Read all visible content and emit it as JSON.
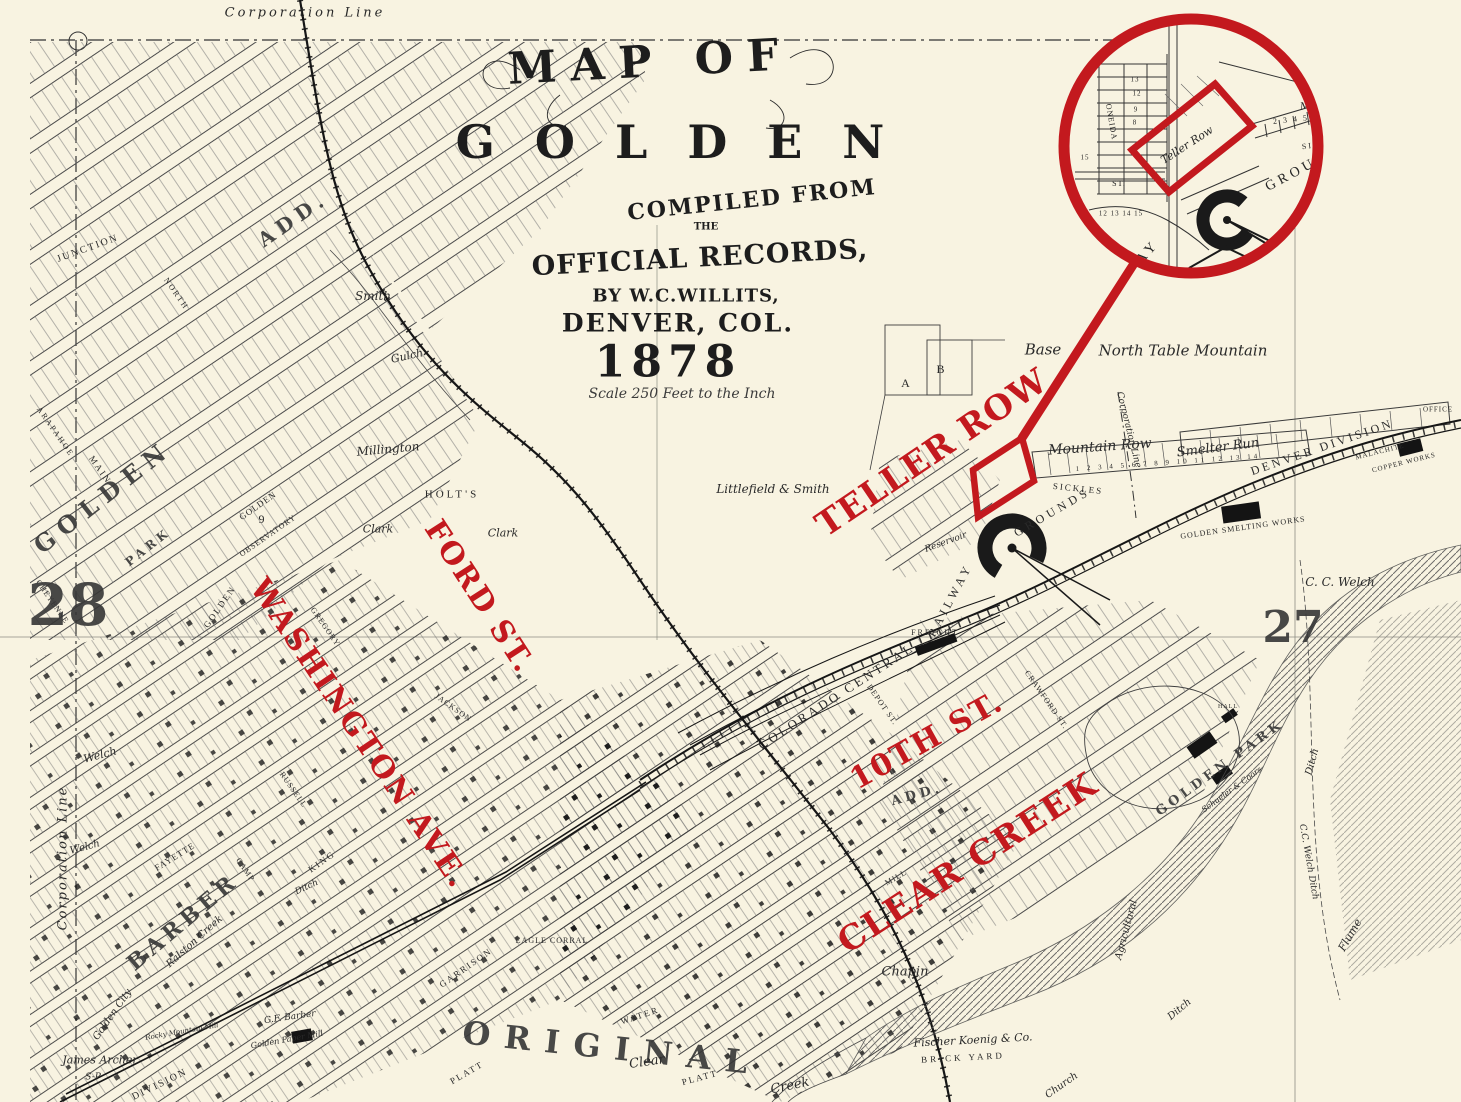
{
  "annotations": {
    "color": "#c3191e",
    "labels": [
      {
        "text": "TELLER ROW",
        "x": 932,
        "y": 453,
        "r": -34,
        "s": 34,
        "ls": 1,
        "cls": "red"
      },
      {
        "text": "FORD ST.",
        "x": 479,
        "y": 597,
        "r": 57,
        "s": 30,
        "ls": 2,
        "cls": "red"
      },
      {
        "text": "WASHINGTON AVE.",
        "x": 359,
        "y": 734,
        "r": 56,
        "s": 30,
        "ls": 2,
        "cls": "red"
      },
      {
        "text": "10TH ST.",
        "x": 927,
        "y": 741,
        "r": -29,
        "s": 30,
        "ls": 2,
        "cls": "red"
      },
      {
        "text": "CLEAR CREEK",
        "x": 968,
        "y": 863,
        "r": -33,
        "s": 34,
        "ls": 2,
        "cls": "red"
      }
    ]
  },
  "title_block": {
    "line_map_of": "MAP OF",
    "line_city": "GOLDEN",
    "line_compiled": "COMPILED FROM",
    "line_the": "THE",
    "line_records": "OFFICIAL RECORDS,",
    "line_by": "BY W.C.WILLITS,",
    "line_place": "DENVER, COL.",
    "line_year": "1878",
    "line_scale": "Scale 250 Feet to the Inch"
  },
  "map_labels": [
    {
      "text": "Corporation Line",
      "x": 305,
      "y": 13,
      "r": 0,
      "s": 13,
      "cls": "hand",
      "ls": 3
    },
    {
      "text": "Corporation Line",
      "x": 63,
      "y": 858,
      "r": -90,
      "s": 13,
      "cls": "hand",
      "ls": 2
    },
    {
      "text": "Corporation Line",
      "x": 1128,
      "y": 430,
      "r": 76,
      "s": 9,
      "cls": "hand"
    },
    {
      "text": "Base",
      "x": 1043,
      "y": 350,
      "r": 0,
      "s": 15,
      "cls": "hand"
    },
    {
      "text": "North Table Mountain",
      "x": 1183,
      "y": 351,
      "r": 0,
      "s": 15,
      "cls": "hand"
    },
    {
      "text": "Littlefield & Smith",
      "x": 773,
      "y": 489,
      "r": 0,
      "s": 12,
      "cls": "hand"
    },
    {
      "text": "Smith",
      "x": 373,
      "y": 296,
      "r": 0,
      "s": 12,
      "cls": "hand"
    },
    {
      "text": "Gulch",
      "x": 407,
      "y": 356,
      "r": -12,
      "s": 11,
      "cls": "hand"
    },
    {
      "text": "Welch",
      "x": 100,
      "y": 755,
      "r": -15,
      "s": 11,
      "cls": "hand"
    },
    {
      "text": "Welch",
      "x": 85,
      "y": 848,
      "r": -15,
      "s": 10,
      "cls": "hand"
    },
    {
      "text": "Millington",
      "x": 388,
      "y": 449,
      "r": -5,
      "s": 12,
      "cls": "hand"
    },
    {
      "text": "HOLT'S",
      "x": 452,
      "y": 495,
      "r": 0,
      "s": 11,
      "cls": "eng",
      "ls": 3
    },
    {
      "text": "Clark",
      "x": 378,
      "y": 529,
      "r": 0,
      "s": 11,
      "cls": "hand"
    },
    {
      "text": "Clark",
      "x": 503,
      "y": 533,
      "r": 0,
      "s": 11,
      "cls": "hand"
    },
    {
      "text": "JUNCTION",
      "x": 88,
      "y": 249,
      "r": -20,
      "s": 10,
      "cls": "eng",
      "ls": 2
    },
    {
      "text": "ARAPAHOE",
      "x": 55,
      "y": 432,
      "r": 55,
      "s": 8,
      "cls": "eng",
      "ls": 2
    },
    {
      "text": "NORTH",
      "x": 176,
      "y": 294,
      "r": 55,
      "s": 8,
      "cls": "eng",
      "ls": 2
    },
    {
      "text": "GOLDEN",
      "x": 103,
      "y": 497,
      "r": -38,
      "s": 24,
      "cls": "big",
      "ls": 8
    },
    {
      "text": "PARK",
      "x": 148,
      "y": 547,
      "r": -38,
      "s": 12,
      "cls": "big",
      "ls": 4
    },
    {
      "text": "ADD.",
      "x": 293,
      "y": 219,
      "r": -35,
      "s": 20,
      "cls": "big",
      "ls": 6
    },
    {
      "text": "MAIN",
      "x": 100,
      "y": 470,
      "r": 55,
      "s": 9,
      "cls": "eng",
      "ls": 2
    },
    {
      "text": "CHEYENNE",
      "x": 52,
      "y": 602,
      "r": 55,
      "s": 8,
      "cls": "eng",
      "ls": 1
    },
    {
      "text": "GOLDEN",
      "x": 220,
      "y": 607,
      "r": -55,
      "s": 9,
      "cls": "eng",
      "ls": 2
    },
    {
      "text": "GOLDEN",
      "x": 258,
      "y": 506,
      "r": -35,
      "s": 9,
      "cls": "eng",
      "ls": 1
    },
    {
      "text": "9",
      "x": 262,
      "y": 519,
      "r": 0,
      "s": 12,
      "cls": "eng"
    },
    {
      "text": "OBSERVATORY",
      "x": 268,
      "y": 536,
      "r": -35,
      "s": 8,
      "cls": "eng",
      "ls": 1
    },
    {
      "text": "GREGORY",
      "x": 325,
      "y": 627,
      "r": 55,
      "s": 8,
      "cls": "eng",
      "ls": 1
    },
    {
      "text": "JACKSON",
      "x": 453,
      "y": 708,
      "r": 35,
      "s": 8,
      "cls": "eng",
      "ls": 1
    },
    {
      "text": "RUSSELL",
      "x": 293,
      "y": 790,
      "r": 55,
      "s": 8,
      "cls": "eng",
      "ls": 1
    },
    {
      "text": "KING",
      "x": 322,
      "y": 862,
      "r": -35,
      "s": 9,
      "cls": "eng",
      "ls": 2
    },
    {
      "text": "FAYETTE",
      "x": 175,
      "y": 857,
      "r": -32,
      "s": 9,
      "cls": "eng",
      "ls": 1
    },
    {
      "text": "CAMP",
      "x": 245,
      "y": 870,
      "r": 55,
      "s": 8,
      "cls": "eng",
      "ls": 1
    },
    {
      "text": "BARBER",
      "x": 183,
      "y": 922,
      "r": -40,
      "s": 22,
      "cls": "big",
      "ls": 5
    },
    {
      "text": "Ditch",
      "x": 307,
      "y": 888,
      "r": -25,
      "s": 9,
      "cls": "hand"
    },
    {
      "text": "Ralston Creek",
      "x": 195,
      "y": 942,
      "r": -42,
      "s": 10,
      "cls": "hand"
    },
    {
      "text": "Golden City",
      "x": 113,
      "y": 1015,
      "r": -55,
      "s": 10,
      "cls": "hand"
    },
    {
      "text": "James Archer",
      "x": 100,
      "y": 1060,
      "r": 0,
      "s": 11,
      "cls": "hand"
    },
    {
      "text": "S-P",
      "x": 93,
      "y": 1078,
      "r": 0,
      "s": 9,
      "cls": "hand"
    },
    {
      "text": "G.F. Barber",
      "x": 290,
      "y": 1018,
      "r": -8,
      "s": 9,
      "cls": "hand"
    },
    {
      "text": "Golden Paper Mill",
      "x": 287,
      "y": 1040,
      "r": -10,
      "s": 8,
      "cls": "hand"
    },
    {
      "text": "Rocky Mountain Mill",
      "x": 182,
      "y": 1032,
      "r": -10,
      "s": 7,
      "cls": "hand"
    },
    {
      "text": "DIVISION",
      "x": 160,
      "y": 1085,
      "r": -26,
      "s": 10,
      "cls": "eng",
      "ls": 2
    },
    {
      "text": "ORIGINAL",
      "x": 612,
      "y": 1048,
      "r": 6,
      "s": 32,
      "cls": "big",
      "ls": 14
    },
    {
      "text": "GARRISON",
      "x": 466,
      "y": 968,
      "r": -35,
      "s": 9,
      "cls": "eng",
      "ls": 2
    },
    {
      "text": "EAGLE CORRAL",
      "x": 552,
      "y": 941,
      "r": 0,
      "s": 8,
      "cls": "eng",
      "ls": 1
    },
    {
      "text": "PLATT",
      "x": 467,
      "y": 1073,
      "r": -30,
      "s": 9,
      "cls": "eng",
      "ls": 2
    },
    {
      "text": "PLATT",
      "x": 700,
      "y": 1078,
      "r": -15,
      "s": 9,
      "cls": "eng",
      "ls": 2
    },
    {
      "text": "WATER",
      "x": 640,
      "y": 1016,
      "r": -18,
      "s": 9,
      "cls": "eng",
      "ls": 2
    },
    {
      "text": "Clear",
      "x": 647,
      "y": 1062,
      "r": -8,
      "s": 13,
      "cls": "hand"
    },
    {
      "text": "Creek",
      "x": 790,
      "y": 1086,
      "r": -12,
      "s": 13,
      "cls": "hand"
    },
    {
      "text": "Chapin",
      "x": 905,
      "y": 972,
      "r": 0,
      "s": 13,
      "cls": "hand"
    },
    {
      "text": "Fischer Koenig & Co.",
      "x": 973,
      "y": 1040,
      "r": -3,
      "s": 11,
      "cls": "hand"
    },
    {
      "text": "BRICK YARD",
      "x": 963,
      "y": 1058,
      "r": -3,
      "s": 9,
      "cls": "eng",
      "ls": 3
    },
    {
      "text": "Church",
      "x": 1062,
      "y": 1086,
      "r": -35,
      "s": 10,
      "cls": "hand"
    },
    {
      "text": "Agricultural",
      "x": 1127,
      "y": 930,
      "r": -75,
      "s": 10,
      "cls": "hand"
    },
    {
      "text": "Flume",
      "x": 1350,
      "y": 935,
      "r": -60,
      "s": 11,
      "cls": "hand"
    },
    {
      "text": "Ditch",
      "x": 1313,
      "y": 762,
      "r": -75,
      "s": 10,
      "cls": "hand"
    },
    {
      "text": "Ditch",
      "x": 1180,
      "y": 1010,
      "r": -40,
      "s": 10,
      "cls": "hand"
    },
    {
      "text": "C. C. Welch",
      "x": 1340,
      "y": 582,
      "r": 0,
      "s": 12,
      "cls": "hand"
    },
    {
      "text": "C.C. Welch Ditch",
      "x": 1308,
      "y": 862,
      "r": 80,
      "s": 9,
      "cls": "hand"
    },
    {
      "text": "GOLDEN PARK",
      "x": 1220,
      "y": 768,
      "r": -36,
      "s": 13,
      "cls": "big",
      "ls": 4
    },
    {
      "text": "HALL",
      "x": 1228,
      "y": 707,
      "r": 0,
      "s": 6,
      "cls": "eng",
      "ls": 1
    },
    {
      "text": "Schueler & Coors",
      "x": 1232,
      "y": 790,
      "r": -36,
      "s": 8,
      "cls": "hand"
    },
    {
      "text": "Mountain Row",
      "x": 1100,
      "y": 447,
      "r": -4,
      "s": 14,
      "cls": "hand"
    },
    {
      "text": "1 2 3 4 5 6 7 8 9 10 11 12 13 14",
      "x": 1168,
      "y": 463,
      "r": -4,
      "s": 7,
      "cls": "eng",
      "ls": 3
    },
    {
      "text": "SICKLES",
      "x": 1078,
      "y": 489,
      "r": 6,
      "s": 9,
      "cls": "eng",
      "ls": 2
    },
    {
      "text": "RAILWAY",
      "x": 950,
      "y": 600,
      "r": -62,
      "s": 12,
      "cls": "eng",
      "ls": 4
    },
    {
      "text": "GROUNDS",
      "x": 1052,
      "y": 512,
      "r": -30,
      "s": 12,
      "cls": "eng",
      "ls": 4
    },
    {
      "text": "Smelter Run",
      "x": 1218,
      "y": 448,
      "r": -7,
      "s": 13,
      "cls": "hand"
    },
    {
      "text": "DENVER DIVISION",
      "x": 1322,
      "y": 447,
      "r": -19,
      "s": 12,
      "cls": "eng",
      "ls": 3
    },
    {
      "text": "MALACHITE",
      "x": 1380,
      "y": 452,
      "r": -14,
      "s": 7,
      "cls": "eng",
      "ls": 1
    },
    {
      "text": "COPPER WORKS",
      "x": 1404,
      "y": 463,
      "r": -14,
      "s": 7,
      "cls": "eng",
      "ls": 1
    },
    {
      "text": "OFFICE",
      "x": 1438,
      "y": 410,
      "r": 0,
      "s": 7,
      "cls": "eng",
      "ls": 1
    },
    {
      "text": "GOLDEN SMELTING WORKS",
      "x": 1243,
      "y": 528,
      "r": -8,
      "s": 8,
      "cls": "eng",
      "ls": 1
    },
    {
      "text": "FREIGHT",
      "x": 935,
      "y": 633,
      "r": 0,
      "s": 8,
      "cls": "eng",
      "ls": 2
    },
    {
      "text": "COLORADO CENTRAL",
      "x": 836,
      "y": 696,
      "r": -33,
      "s": 13,
      "cls": "eng",
      "ls": 3
    },
    {
      "text": "DEPOT ST.",
      "x": 882,
      "y": 705,
      "r": 55,
      "s": 8,
      "cls": "eng",
      "ls": 1
    },
    {
      "text": "CRAWFORD ST.",
      "x": 1046,
      "y": 700,
      "r": 55,
      "s": 8,
      "cls": "eng",
      "ls": 1
    },
    {
      "text": "MILL",
      "x": 896,
      "y": 878,
      "r": -30,
      "s": 8,
      "cls": "eng",
      "ls": 1
    },
    {
      "text": "ADD.",
      "x": 917,
      "y": 795,
      "r": -15,
      "s": 13,
      "cls": "big",
      "ls": 4
    },
    {
      "text": "Reservoir",
      "x": 946,
      "y": 543,
      "r": -20,
      "s": 9,
      "cls": "hand"
    },
    {
      "text": "A",
      "x": 906,
      "y": 383,
      "r": 0,
      "s": 12,
      "cls": "eng"
    },
    {
      "text": "B",
      "x": 941,
      "y": 369,
      "r": 0,
      "s": 12,
      "cls": "eng"
    },
    {
      "text": "28",
      "x": 68,
      "y": 605,
      "r": 0,
      "s": 58,
      "cls": "big"
    },
    {
      "text": "27",
      "x": 1293,
      "y": 628,
      "r": 0,
      "s": 44,
      "cls": "big"
    }
  ],
  "inset": {
    "labels": [
      {
        "text": "Teller Row",
        "x": 118,
        "y": 121,
        "r": -33,
        "s": 11,
        "cls": "hand"
      },
      {
        "text": "ONEIDA",
        "x": 42,
        "y": 98,
        "r": 80,
        "s": 8,
        "cls": "eng"
      },
      {
        "text": "ST.",
        "x": 50,
        "y": 160,
        "r": 0,
        "s": 8,
        "cls": "eng"
      },
      {
        "text": "RAILWAY",
        "x": 58,
        "y": 252,
        "r": -48,
        "s": 14,
        "cls": "eng",
        "ls": 4
      },
      {
        "text": "GROUNDS",
        "x": 240,
        "y": 142,
        "r": -28,
        "s": 14,
        "cls": "eng",
        "ls": 4
      },
      {
        "text": "SICKLES",
        "x": 256,
        "y": 120,
        "r": -8,
        "s": 8,
        "cls": "eng",
        "ls": 2
      },
      {
        "text": "Mountain Row",
        "x": 268,
        "y": 80,
        "r": -6,
        "s": 10,
        "cls": "hand"
      },
      {
        "text": "2 3 4 5",
        "x": 222,
        "y": 96,
        "r": -6,
        "s": 8,
        "cls": "eng",
        "ls": 2
      },
      {
        "text": "13",
        "x": 66,
        "y": 56,
        "r": 0,
        "s": 7,
        "cls": "eng"
      },
      {
        "text": "12",
        "x": 68,
        "y": 70,
        "r": 0,
        "s": 7,
        "cls": "eng"
      },
      {
        "text": "9",
        "x": 67,
        "y": 86,
        "r": 0,
        "s": 7,
        "cls": "eng"
      },
      {
        "text": "8",
        "x": 66,
        "y": 99,
        "r": 0,
        "s": 7,
        "cls": "eng"
      },
      {
        "text": "15",
        "x": 16,
        "y": 134,
        "r": 0,
        "s": 7,
        "cls": "eng"
      },
      {
        "text": "12 13 14 15",
        "x": 52,
        "y": 190,
        "r": 0,
        "s": 7,
        "cls": "eng",
        "ls": 1
      }
    ]
  }
}
